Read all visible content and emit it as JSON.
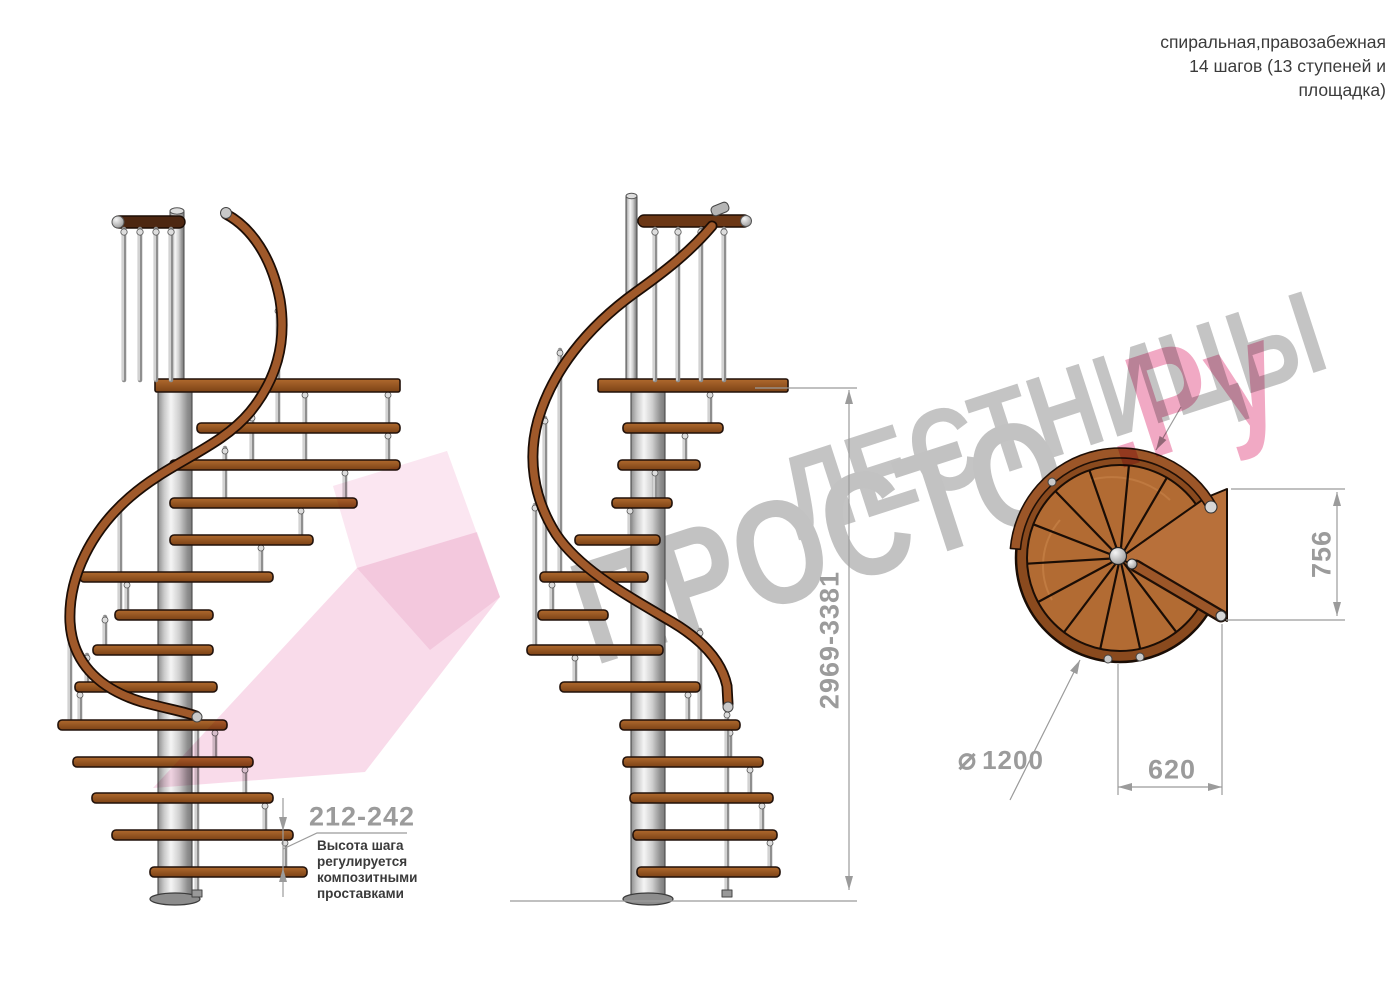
{
  "header": {
    "line1": "спиральная,правозабежная",
    "line2": "14 шагов (13 ступеней и",
    "line3": "площадка)"
  },
  "dimensions": {
    "step_height": "212-242",
    "step_height_note": "Высота шага\nрегулируется\nкомпозитными\nпроставками",
    "total_height": "2969-3381",
    "platform_width": "756",
    "step_length": "620",
    "diameter_symbol": "⌀",
    "diameter_value": "1200"
  },
  "watermark": {
    "line1": "ЛЕСТНИЦЫ",
    "line2_gray": "ПРОСТО",
    "line2_pink": ".Ру"
  },
  "colors": {
    "watermark_gray": "#c4c4c4",
    "watermark_pink": "#f1a9c4",
    "logo_pink": "#f4bdd8",
    "dim_gray": "#9b9b9b",
    "text_dark": "#3b3b3b",
    "wood": "#96521f",
    "wood_light": "#b8703a",
    "wood_rail": "#a0592a",
    "wood_dark_rail": "#4d2711",
    "outline": "#21110a",
    "metal_light": "#f2f2f2",
    "metal_mid": "#c9c9c9",
    "metal_dark": "#8f8f8f"
  }
}
